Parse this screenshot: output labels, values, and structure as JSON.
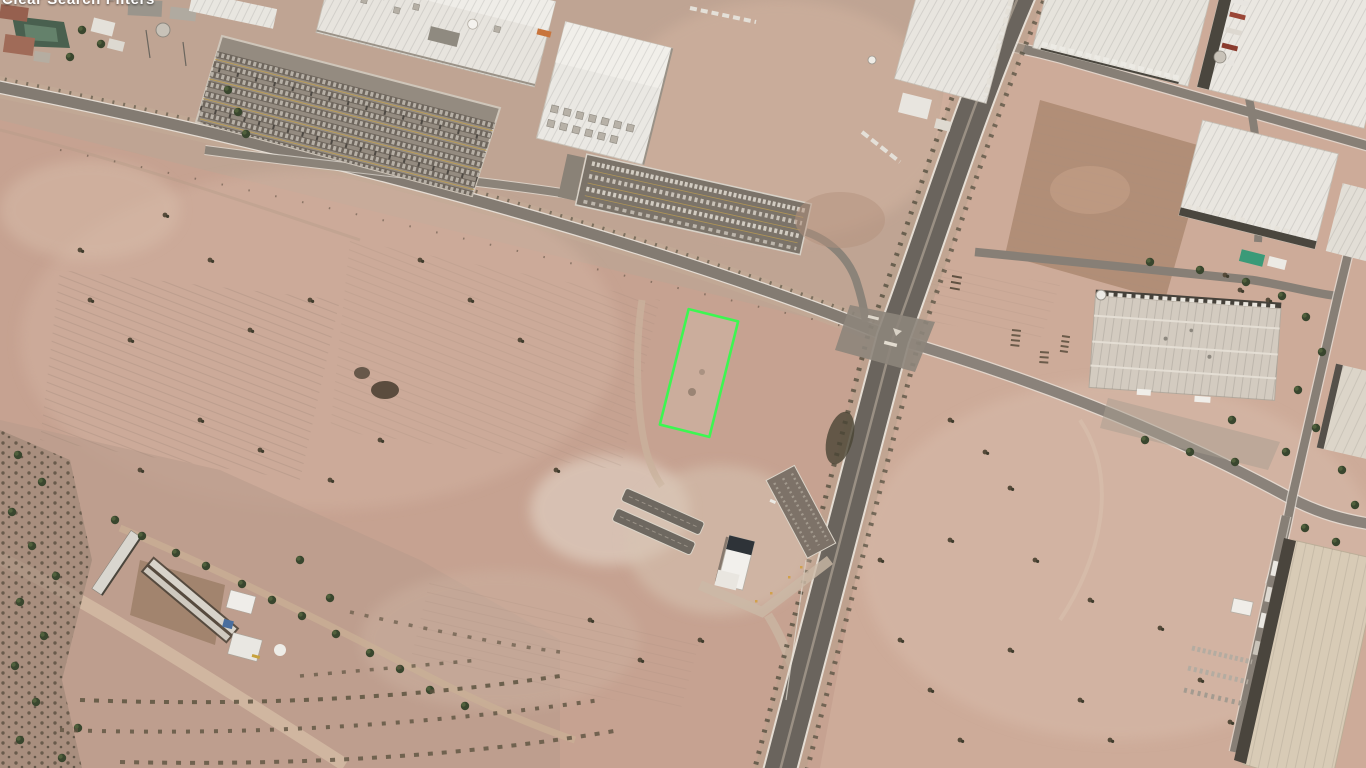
{
  "caption": {
    "text": "Clear Search Filters"
  },
  "annotation": {
    "name": "highlighted-parcel-outline",
    "color": "#3CF751",
    "shape": "rotated-rectangle"
  },
  "scene": {
    "type": "satellite-aerial-imagery",
    "setting": "desert industrial district beside a divided highway interchange",
    "palette": {
      "desert_base": "#C6A291",
      "desert_light": "#D4B5A4",
      "asphalt": "#7E766D",
      "highway": "#6A645D",
      "dirt_road": "#D3B9A3",
      "roof_white": "#E9E6E1",
      "roof_beige": "#D7CAB5",
      "dirt_lot_brown": "#B18E77",
      "vegetation_dark": "#45412F",
      "parcel_interior": "#D9C8BB"
    },
    "features": [
      "industrial-plant",
      "white-warehouses",
      "car-parking-lot",
      "trailer-yard",
      "divided-highway",
      "arterial-road",
      "cross-road",
      "dirt-roads",
      "vacant-desert-parcels",
      "graded-dirt-lot",
      "farm-compound",
      "inspection-facility",
      "scrub-vegetation",
      "highlighted-parcel"
    ]
  }
}
